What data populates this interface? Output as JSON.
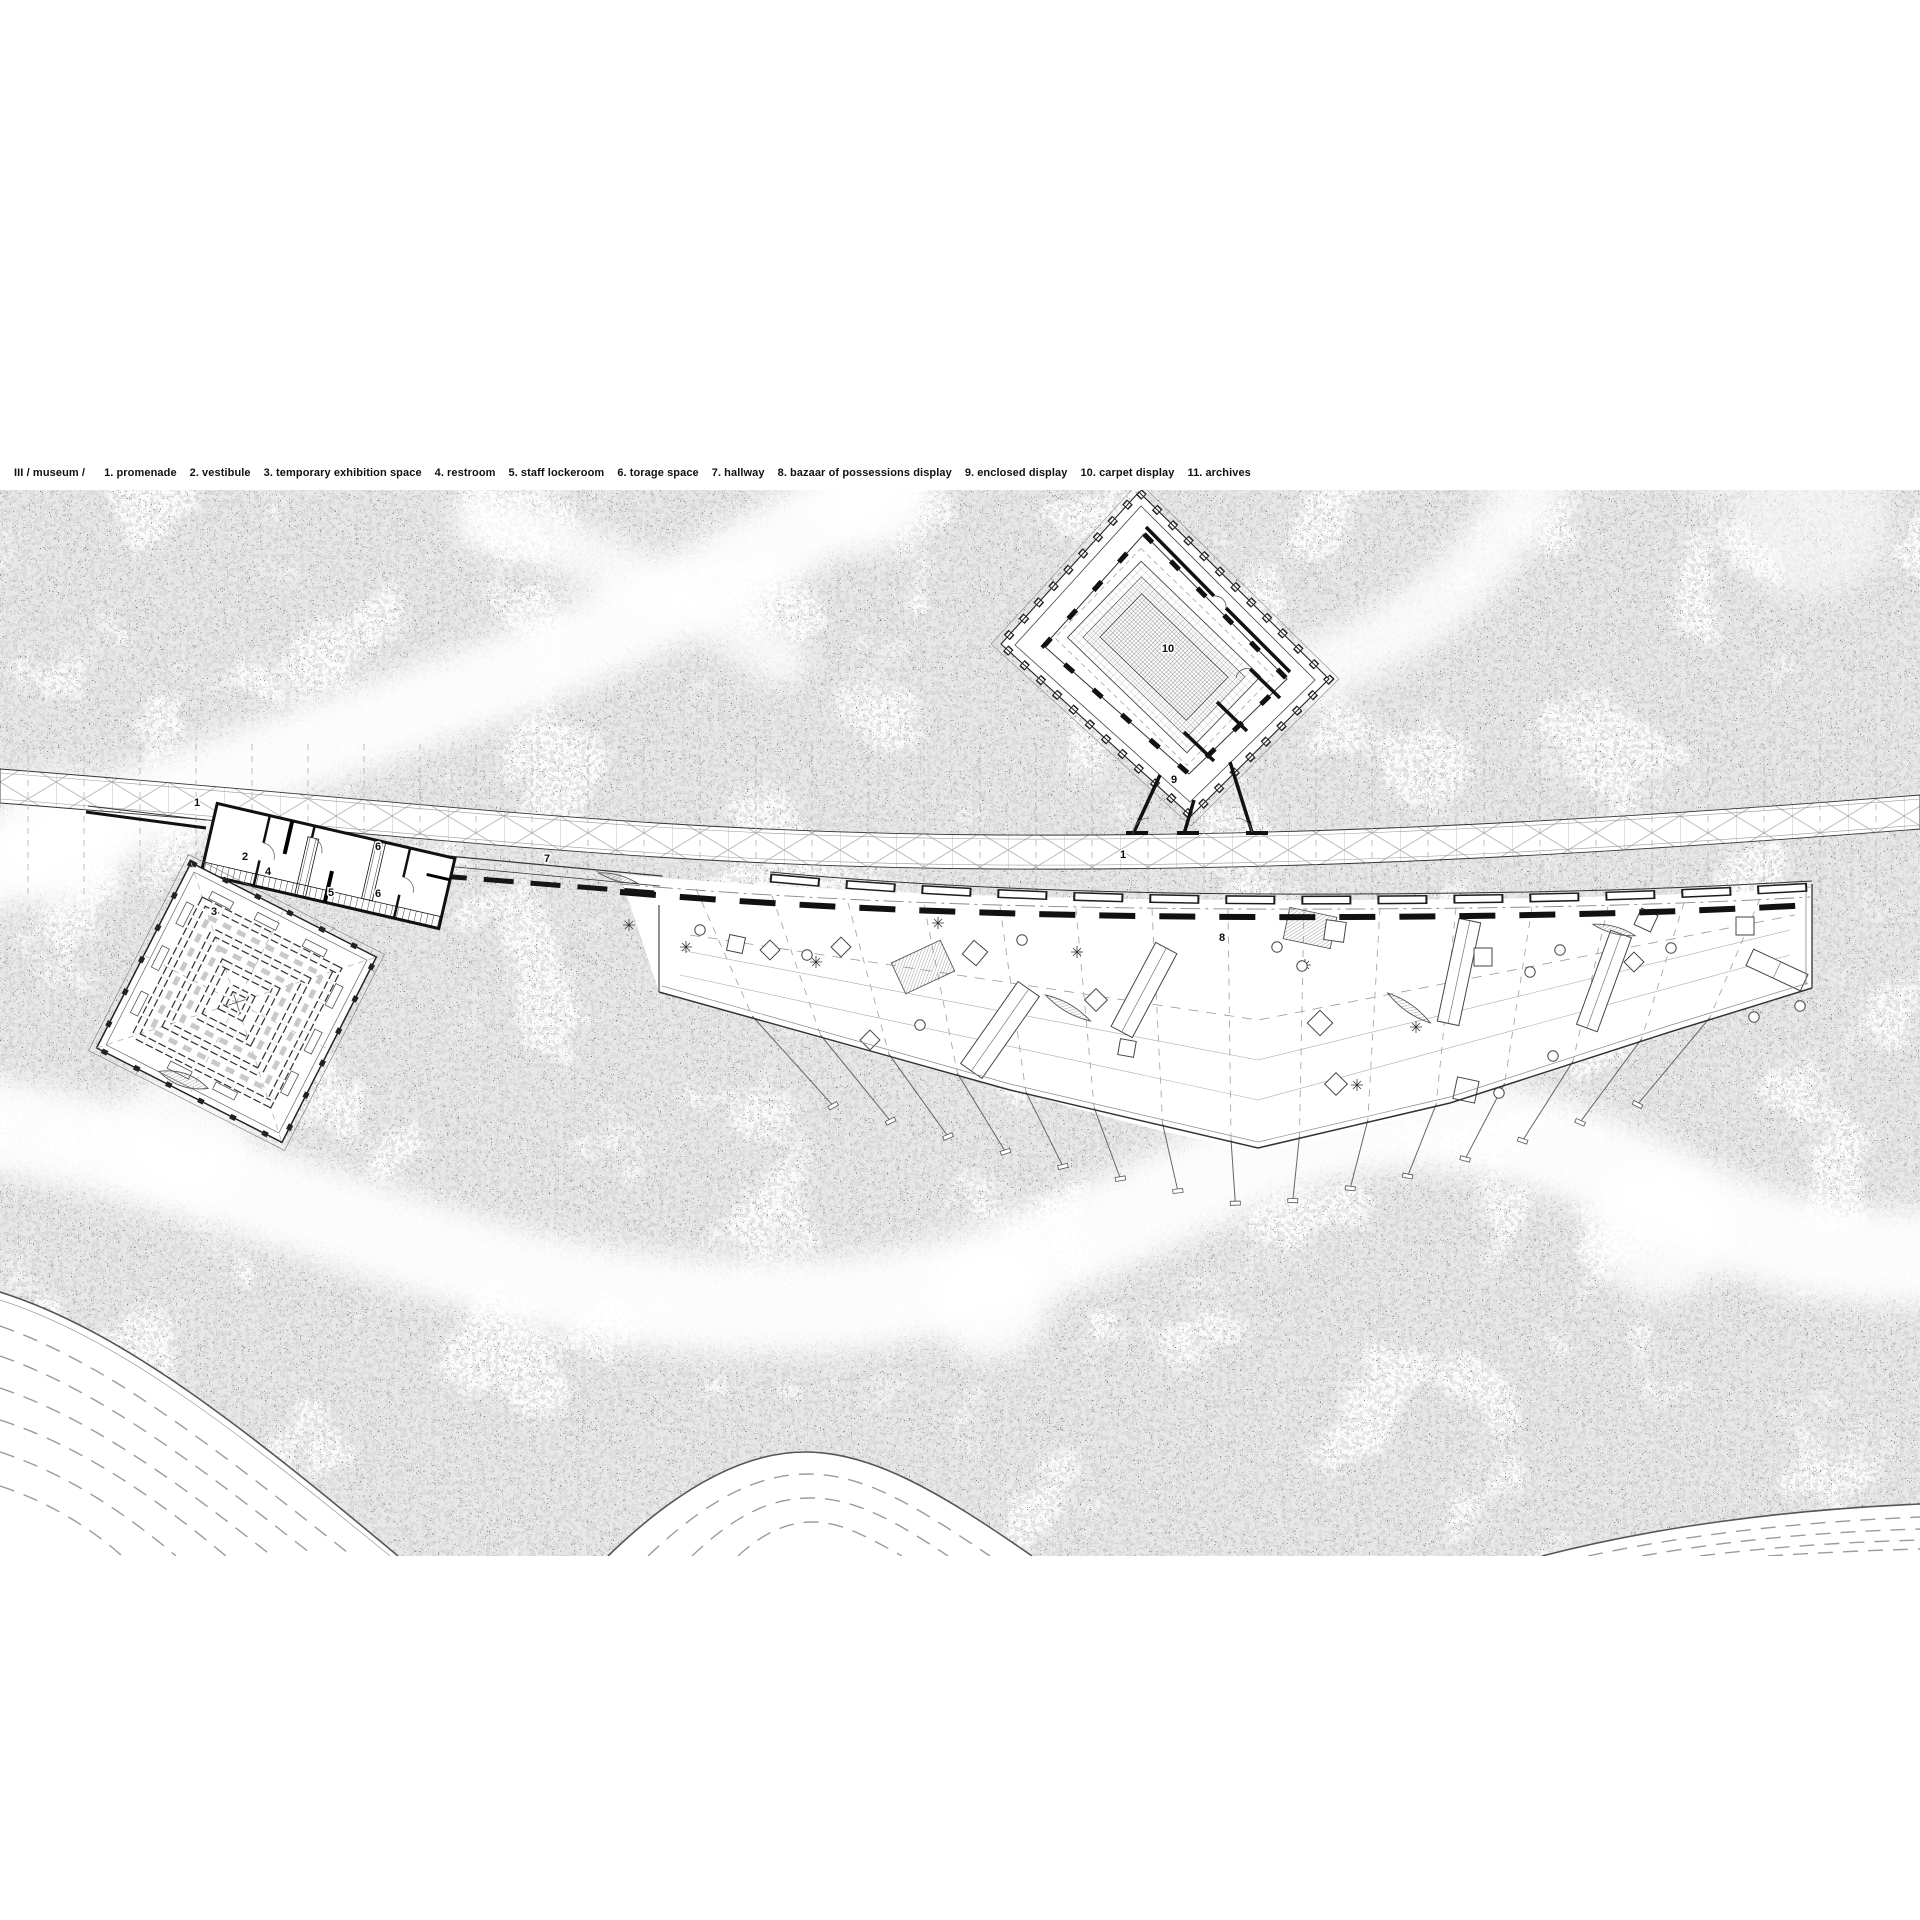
{
  "legend": {
    "prefix": "III / museum  /",
    "items": [
      {
        "num": "1.",
        "label": "promenade"
      },
      {
        "num": "2.",
        "label": "vestibule"
      },
      {
        "num": "3.",
        "label": "temporary exhibition space"
      },
      {
        "num": "4.",
        "label": "restroom"
      },
      {
        "num": "5.",
        "label": "staff lockeroom"
      },
      {
        "num": "6.",
        "label": "torage space"
      },
      {
        "num": "7.",
        "label": "hallway"
      },
      {
        "num": "8.",
        "label": "bazaar of possessions display"
      },
      {
        "num": "9.",
        "label": "enclosed display"
      },
      {
        "num": "10.",
        "label": "carpet display"
      },
      {
        "num": "11.",
        "label": "archives"
      }
    ]
  },
  "plan": {
    "labels": [
      {
        "text": "1",
        "x": 197,
        "y": 806
      },
      {
        "text": "1",
        "x": 1123,
        "y": 858
      },
      {
        "text": "2",
        "x": 245,
        "y": 860
      },
      {
        "text": "3",
        "x": 214,
        "y": 915
      },
      {
        "text": "4",
        "x": 268,
        "y": 875
      },
      {
        "text": "5",
        "x": 331,
        "y": 896
      },
      {
        "text": "6",
        "x": 378,
        "y": 850
      },
      {
        "text": "6",
        "x": 378,
        "y": 897
      },
      {
        "text": "7",
        "x": 547,
        "y": 862
      },
      {
        "text": "8",
        "x": 1222,
        "y": 941
      },
      {
        "text": "9",
        "x": 1174,
        "y": 783
      },
      {
        "text": "10",
        "x": 1168,
        "y": 652
      }
    ],
    "colors": {
      "ink": "#1c1c1c",
      "grid": "#9a9a9a",
      "texture": "#a8a8a8",
      "paper": "#ffffff"
    }
  }
}
